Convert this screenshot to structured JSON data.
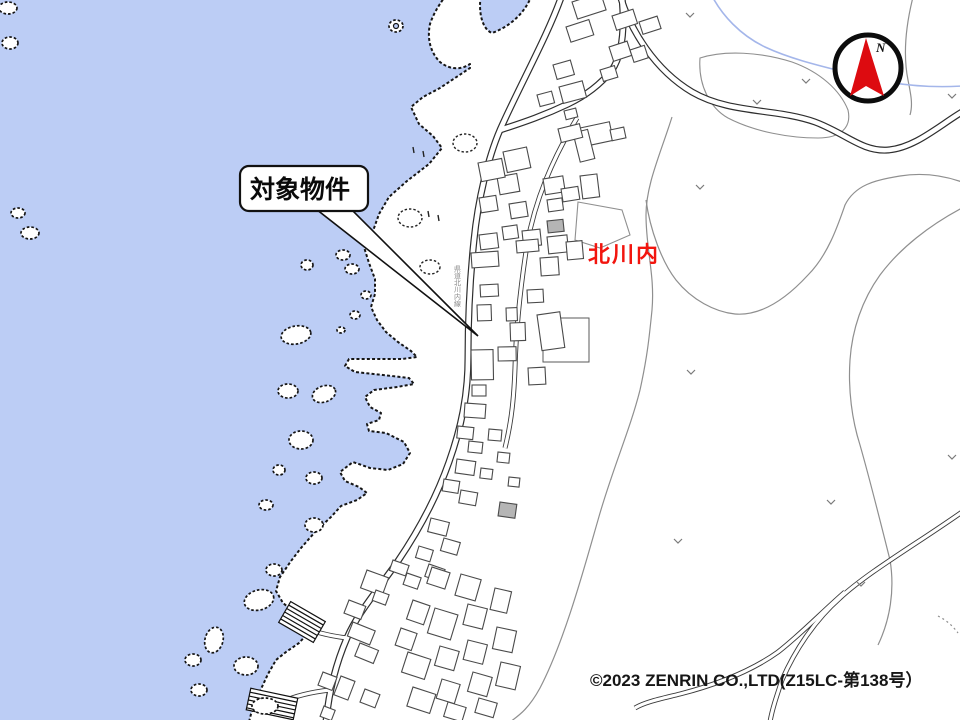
{
  "map": {
    "callout": {
      "label": "対象物件"
    },
    "place_label": {
      "text": "北川内",
      "color": "#f2150e"
    },
    "road_label": {
      "text": "県道北川内線"
    },
    "compass": {
      "label": "N",
      "needle_color": "#dd0b10"
    },
    "copyright": {
      "text": "©2023 ZENRIN CO.,LTD(Z15LC-第138号）"
    },
    "colors": {
      "water": "#bccdf5",
      "land": "#ffffff",
      "coastline": "#151515",
      "road": "#2e2e2e",
      "parcel_line": "#8f8f8f",
      "building_outline": "#4a4a4a",
      "building_fill_public": "#b5b5b5",
      "stream": "#a4b6ea",
      "accent_red": "#f2150e"
    },
    "features": {
      "buildings": [
        [
          572,
          2,
          30,
          18,
          -18
        ],
        [
          566,
          27,
          24,
          16,
          -18
        ],
        [
          612,
          16,
          22,
          15,
          -18
        ],
        [
          639,
          22,
          19,
          13,
          -18
        ],
        [
          609,
          47,
          19,
          15,
          -18
        ],
        [
          630,
          50,
          15,
          13,
          -18
        ],
        [
          553,
          65,
          18,
          15,
          -16
        ],
        [
          559,
          87,
          24,
          17,
          -15
        ],
        [
          537,
          95,
          15,
          12,
          -15
        ],
        [
          564,
          111,
          12,
          9,
          -14
        ],
        [
          600,
          70,
          15,
          12,
          -17
        ],
        [
          580,
          128,
          30,
          19,
          -12
        ],
        [
          610,
          130,
          14,
          11,
          -12
        ],
        [
          503,
          152,
          24,
          21,
          -12
        ],
        [
          497,
          177,
          20,
          18,
          -10
        ],
        [
          509,
          204,
          17,
          15,
          -9
        ],
        [
          502,
          227,
          15,
          13,
          -8
        ],
        [
          543,
          179,
          20,
          16,
          -9
        ],
        [
          561,
          189,
          17,
          13,
          -9
        ],
        [
          547,
          200,
          15,
          12,
          -8
        ],
        [
          573,
          133,
          15,
          30,
          -14
        ],
        [
          558,
          129,
          22,
          14,
          -14
        ],
        [
          580,
          176,
          17,
          23,
          -7
        ],
        [
          522,
          231,
          18,
          16,
          -6
        ],
        [
          547,
          237,
          20,
          17,
          -6
        ],
        [
          566,
          242,
          16,
          18,
          -5
        ],
        [
          547,
          221,
          16,
          12,
          -6,
          1
        ],
        [
          478,
          163,
          24,
          19,
          -11
        ],
        [
          479,
          198,
          17,
          15,
          -9
        ],
        [
          479,
          235,
          18,
          15,
          -7
        ],
        [
          516,
          241,
          22,
          12,
          -5
        ],
        [
          540,
          258,
          18,
          18,
          -4
        ],
        [
          527,
          290,
          16,
          13,
          -3
        ],
        [
          506,
          308,
          11,
          13,
          -2
        ],
        [
          510,
          323,
          15,
          18,
          -2
        ],
        [
          498,
          347,
          18,
          14,
          -1
        ],
        [
          537,
          315,
          23,
          36,
          -8
        ],
        [
          528,
          368,
          17,
          17,
          -3
        ],
        [
          471,
          253,
          27,
          15,
          -4
        ],
        [
          480,
          285,
          18,
          12,
          -3
        ],
        [
          477,
          305,
          14,
          16,
          -2
        ],
        [
          471,
          350,
          22,
          30,
          -1
        ],
        [
          472,
          385,
          14,
          11,
          0
        ],
        [
          465,
          403,
          21,
          14,
          4
        ],
        [
          458,
          426,
          16,
          12,
          6
        ],
        [
          469,
          441,
          14,
          11,
          6
        ],
        [
          457,
          459,
          19,
          14,
          8
        ],
        [
          444,
          479,
          16,
          12,
          9
        ],
        [
          461,
          490,
          17,
          13,
          10
        ],
        [
          489,
          429,
          13,
          11,
          5
        ],
        [
          498,
          452,
          12,
          10,
          6
        ],
        [
          481,
          468,
          12,
          10,
          7
        ],
        [
          500,
          502,
          17,
          14,
          8,
          1
        ],
        [
          509,
          477,
          11,
          9,
          6
        ],
        [
          431,
          518,
          19,
          14,
          14
        ],
        [
          444,
          538,
          17,
          13,
          16
        ],
        [
          419,
          546,
          15,
          12,
          17
        ],
        [
          429,
          564,
          17,
          13,
          19
        ],
        [
          407,
          573,
          15,
          12,
          19
        ],
        [
          367,
          570,
          23,
          19,
          20
        ],
        [
          376,
          590,
          14,
          11,
          20
        ],
        [
          349,
          600,
          18,
          14,
          21
        ],
        [
          353,
          622,
          24,
          15,
          22
        ],
        [
          360,
          643,
          20,
          14,
          22
        ],
        [
          393,
          560,
          17,
          11,
          19
        ],
        [
          432,
          567,
          19,
          17,
          18
        ],
        [
          461,
          574,
          21,
          22,
          16
        ],
        [
          495,
          588,
          17,
          22,
          13
        ],
        [
          413,
          600,
          18,
          20,
          19
        ],
        [
          435,
          608,
          24,
          26,
          17
        ],
        [
          468,
          604,
          20,
          21,
          14
        ],
        [
          497,
          627,
          20,
          22,
          12
        ],
        [
          401,
          628,
          17,
          18,
          19
        ],
        [
          440,
          646,
          20,
          20,
          16
        ],
        [
          468,
          640,
          20,
          20,
          14
        ],
        [
          323,
          672,
          15,
          14,
          21
        ],
        [
          341,
          676,
          15,
          20,
          21
        ],
        [
          365,
          689,
          16,
          14,
          21
        ],
        [
          324,
          706,
          12,
          11,
          21
        ],
        [
          408,
          652,
          24,
          21,
          18
        ],
        [
          442,
          679,
          19,
          20,
          17
        ],
        [
          473,
          672,
          20,
          20,
          16
        ],
        [
          501,
          662,
          20,
          24,
          13
        ],
        [
          413,
          687,
          24,
          20,
          18
        ],
        [
          448,
          702,
          19,
          15,
          17
        ],
        [
          479,
          698,
          19,
          15,
          16
        ]
      ],
      "islands": [
        [
          8,
          8,
          9,
          6,
          0
        ],
        [
          10,
          43,
          8,
          6,
          0
        ],
        [
          18,
          213,
          7,
          5,
          0
        ],
        [
          30,
          233,
          9,
          6,
          0
        ],
        [
          336,
          208,
          11,
          7,
          -15
        ],
        [
          307,
          265,
          6,
          5,
          0
        ],
        [
          343,
          255,
          7,
          5,
          0
        ],
        [
          352,
          269,
          7,
          5,
          0
        ],
        [
          366,
          295,
          5,
          4,
          0
        ],
        [
          355,
          315,
          5,
          4,
          0
        ],
        [
          341,
          330,
          4,
          3,
          0
        ],
        [
          296,
          335,
          15,
          9,
          -10
        ],
        [
          288,
          391,
          10,
          7,
          0
        ],
        [
          324,
          394,
          12,
          8,
          -20
        ],
        [
          301,
          440,
          12,
          9,
          0
        ],
        [
          279,
          470,
          6,
          5,
          0
        ],
        [
          314,
          478,
          8,
          6,
          0
        ],
        [
          266,
          505,
          7,
          5,
          0
        ],
        [
          314,
          525,
          9,
          7,
          0
        ],
        [
          274,
          570,
          8,
          6,
          0
        ],
        [
          259,
          600,
          15,
          10,
          -15
        ],
        [
          214,
          640,
          9,
          13,
          15
        ],
        [
          193,
          660,
          8,
          6,
          0
        ],
        [
          246,
          666,
          12,
          9,
          0
        ],
        [
          199,
          690,
          8,
          6,
          0
        ],
        [
          265,
          706,
          13,
          8,
          0
        ]
      ],
      "donut_island": [
        396,
        26,
        7,
        6,
        2.5
      ],
      "rock_ovals": [
        [
          410,
          218,
          12,
          9
        ],
        [
          430,
          267,
          10,
          7
        ],
        [
          465,
          143,
          12,
          9
        ]
      ],
      "rock_ticks": [
        [
          413,
          150
        ],
        [
          423,
          154
        ],
        [
          428,
          214
        ],
        [
          438,
          218
        ]
      ],
      "veg_marks": [
        [
          690,
          15
        ],
        [
          806,
          81
        ],
        [
          757,
          102
        ],
        [
          952,
          96
        ],
        [
          700,
          187
        ],
        [
          691,
          372
        ],
        [
          678,
          541
        ],
        [
          831,
          502
        ],
        [
          861,
          584
        ],
        [
          952,
          457
        ]
      ],
      "piers": [
        {
          "cx": 302,
          "cy": 622,
          "w": 40,
          "h": 24,
          "rot": 30
        },
        {
          "cx": 272,
          "cy": 704,
          "w": 48,
          "h": 22,
          "rot": 12
        }
      ]
    }
  }
}
